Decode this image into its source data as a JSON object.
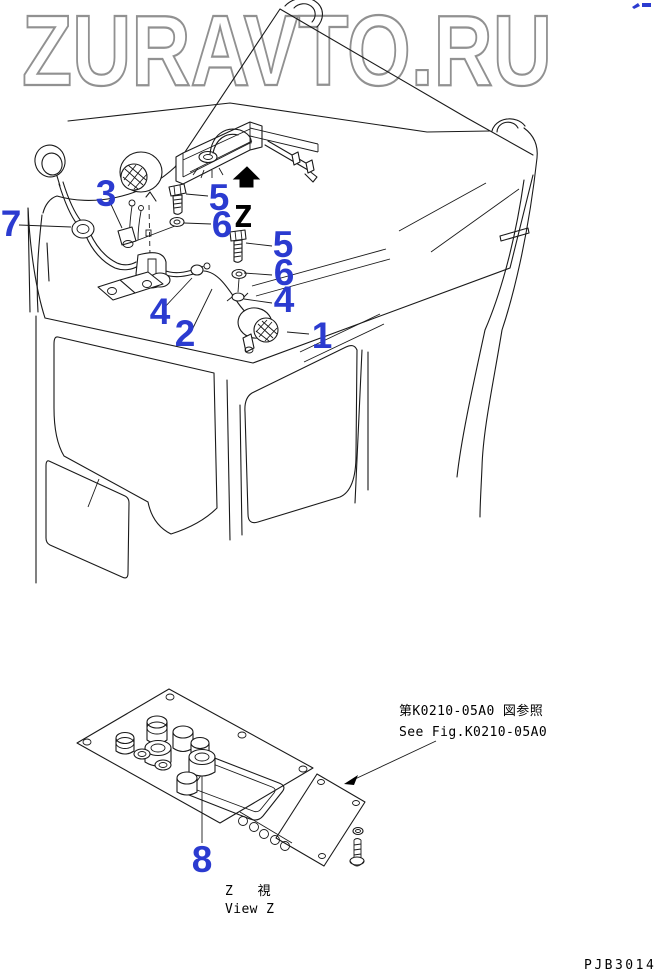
{
  "watermark": "ZURAVTO.RU",
  "drawing": {
    "view_arrow_label": "Z",
    "callouts": [
      {
        "id": "7"
      },
      {
        "id": "3"
      },
      {
        "id": "5"
      },
      {
        "id": "6"
      },
      {
        "id": "5"
      },
      {
        "id": "6"
      },
      {
        "id": "4"
      },
      {
        "id": "4"
      },
      {
        "id": "2"
      },
      {
        "id": "1"
      },
      {
        "id": "8"
      }
    ]
  },
  "notes": {
    "reference_jp": "第K0210-05A0 図参照",
    "reference_en": "See Fig.K0210-05A0",
    "view_caption_jp": "Z 視",
    "view_caption_en": "View Z",
    "drawing_number": "PJB3014"
  },
  "colors": {
    "callout_blue": "#2b3bd0",
    "line_black": "#1a1a1a",
    "watermark_gray": "#919191"
  }
}
